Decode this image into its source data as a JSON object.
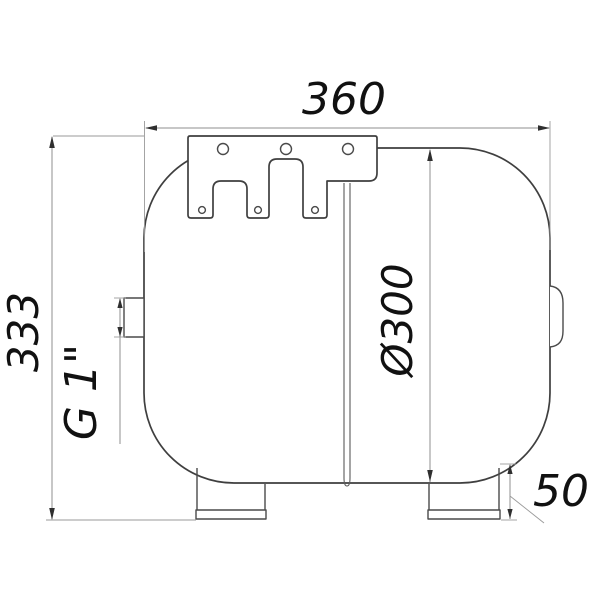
{
  "drawing": {
    "type": "technical-dimension-drawing",
    "labels": {
      "overall_width": "360",
      "overall_height": "333",
      "tank_diameter": "Ø300",
      "thread_connection": "G 1\"",
      "foot_height": "50"
    },
    "colors": {
      "background": "#ffffff",
      "outline": "#3f3f3f",
      "dimension_line": "#8f8f8f",
      "text": "#111111"
    }
  }
}
